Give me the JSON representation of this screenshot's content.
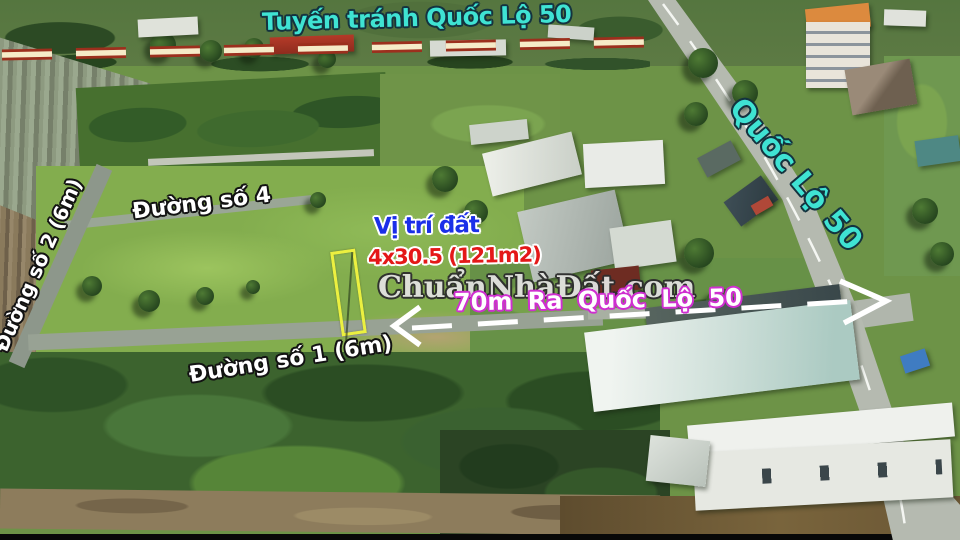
{
  "annotations": {
    "bypass_label": "Tuyến tránh Quốc Lộ 50",
    "highway_label": "Quốc Lộ 50",
    "road4_label": "Đường số 4",
    "road2_label": "Đường số 2 (6m)",
    "road1_label": "Đường số 1 (6m)",
    "plot_marker_title": "Vị trí đất",
    "plot_size_label": "4x30.5 (121m2)",
    "distance_label": "70m Ra Quốc Lộ 50",
    "watermark": "ChuẩnNhàĐất.com"
  },
  "colors": {
    "annotation_cyan": "#3fe3d3",
    "plot_title_blue": "#1b2fe8",
    "plot_size_red": "#e41818",
    "distance_outline_magenta": "#cf2fd0",
    "plot_outline_yellow": "#ecf040",
    "bypass_dash_fill": "#f6ebc8",
    "bypass_dash_border": "#9c2f1d",
    "road_label_white": "#ffffff"
  }
}
